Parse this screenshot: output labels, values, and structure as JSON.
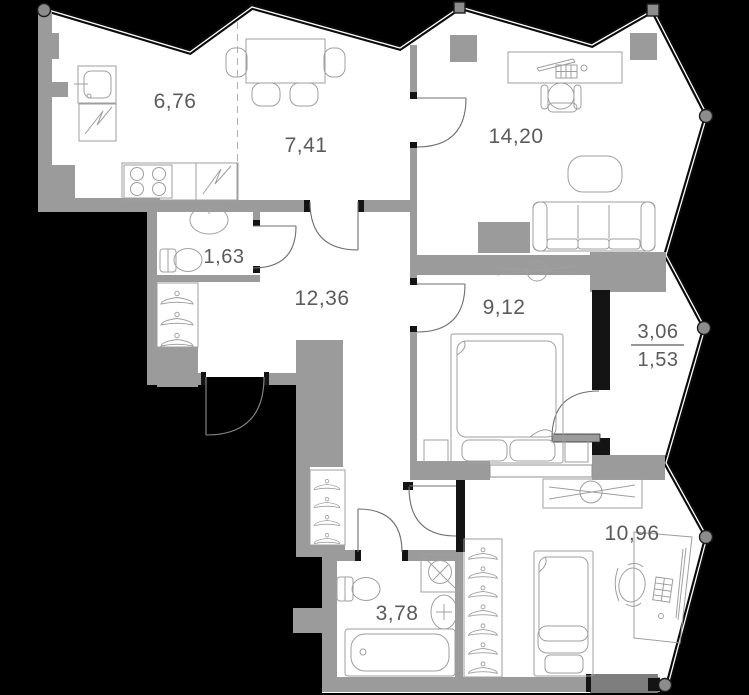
{
  "plan_title": "apartment-floor-plan",
  "labels": {
    "kitchen": "6,76",
    "dining": "7,41",
    "living": "14,20",
    "bath_small": "1,63",
    "hall": "12,36",
    "bedroom_main": "9,12",
    "balcony_full": "3,06",
    "balcony_half": "1,53",
    "bedroom_second": "10,96",
    "bath_main": "3,78"
  },
  "icons": [
    "kitchen-sink-icon",
    "fridge-zigzag-icon",
    "stove-icon",
    "dining-table-icon",
    "chair-icon",
    "desk-icon",
    "office-chair-icon",
    "keyboard-icon",
    "mouse-icon",
    "coffee-table-icon",
    "sofa-icon",
    "washbasin-icon",
    "toilet-icon",
    "hanger-icon",
    "tv-console-icon",
    "double-bed-icon",
    "nightstand-icon",
    "single-bed-icon",
    "washing-machine-icon",
    "bathtub-icon",
    "door-swing-icon",
    "wall-node-icon"
  ],
  "colors": {
    "background": "#000000",
    "floor": "#ffffff",
    "wall_gray": "#9b9b9b",
    "wall_black": "#141414",
    "furniture_line": "#9f9f9f",
    "label_text": "#5b5b5b"
  }
}
